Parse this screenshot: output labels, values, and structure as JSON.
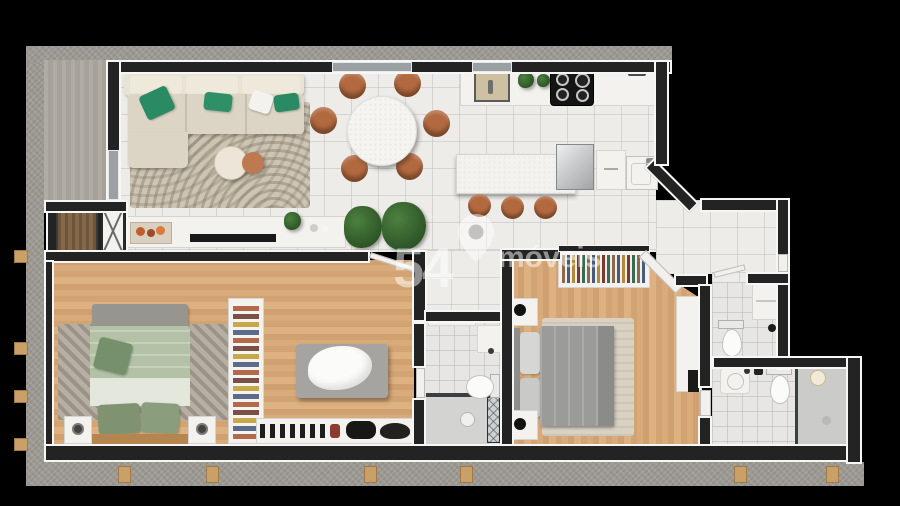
{
  "brand_watermark": {
    "number": "54",
    "name": "móveis",
    "icon": "location-pin-icon"
  },
  "palette": {
    "background": "#000000",
    "wall_core": "#232323",
    "wall_trim": "#f6f6f4",
    "concrete_shell": "#9c9892",
    "tile_floor": "#edece9",
    "wood_floor": "#d3a473",
    "deck_floor": "#aba69d",
    "terracotta_chairs": "#b2693f",
    "sofa_cream": "#dcd5c5",
    "pillow_green": "#2a8a63",
    "bedding_sage": "#b3c2a6",
    "bedding_gray": "#9b9b99",
    "bathroom_tile": "#e7e6e4",
    "wood_bracket": "#c8a068",
    "watermark_white": "rgba(255,255,255,0.5)"
  },
  "floorplan": {
    "type": "apartment-top-view-render",
    "rooms": [
      {
        "id": "side-balcony",
        "furniture": [
          "deck-floor"
        ]
      },
      {
        "id": "living-room",
        "furniture": [
          "l-shaped-sofa",
          "green-throw-pillows",
          "patterned-area-rug",
          "round-coffee-table-cream",
          "round-coffee-table-terracotta",
          "tv-console",
          "tv-soundbar",
          "decor-tray",
          "potted-plant-large-x2",
          "potted-plant-small"
        ]
      },
      {
        "id": "dining-area",
        "furniture": [
          "round-dining-table",
          "dining-chair-x6"
        ]
      },
      {
        "id": "kitchen",
        "furniture": [
          "counter-with-sink",
          "cooktop-4-burner",
          "herb-plants-x2",
          "island-counter",
          "bar-stool-x3",
          "refrigerator",
          "cabinet",
          "laundry-tub"
        ]
      },
      {
        "id": "hallway",
        "furniture": []
      },
      {
        "id": "service-core",
        "furniture": [
          "storage-shaft",
          "elevator"
        ]
      },
      {
        "id": "master-bedroom",
        "furniture": [
          "double-bed-sage",
          "foot-bench",
          "nightstand-x2",
          "table-lamp-x2",
          "diagonal-striped-rug"
        ]
      },
      {
        "id": "walk-in-closet",
        "furniture": [
          "folded-clothes-shelf",
          "center-island-bench-with-drape",
          "shoe-shelf",
          "handbags-x2"
        ]
      },
      {
        "id": "bathroom-1",
        "furniture": [
          "towel-shelf",
          "vanity-cabinet",
          "toilet",
          "walk-in-shower-glass"
        ]
      },
      {
        "id": "bedroom-2",
        "furniture": [
          "double-bed-gray",
          "nightstand-x2",
          "black-table-lamp-x2",
          "hanging-clothes-rack",
          "desk-console",
          "tv-panel",
          "beige-rug"
        ]
      },
      {
        "id": "powder-room",
        "furniture": [
          "wall-cabinet",
          "toilet"
        ]
      },
      {
        "id": "bathroom-2",
        "furniture": [
          "basin",
          "toilet",
          "shower-area",
          "pendant-light"
        ]
      }
    ],
    "counts": {
      "dining_chairs": 6,
      "bar_stools": 3,
      "bedrooms": 2,
      "bathrooms": 3,
      "elevators": 1
    }
  }
}
